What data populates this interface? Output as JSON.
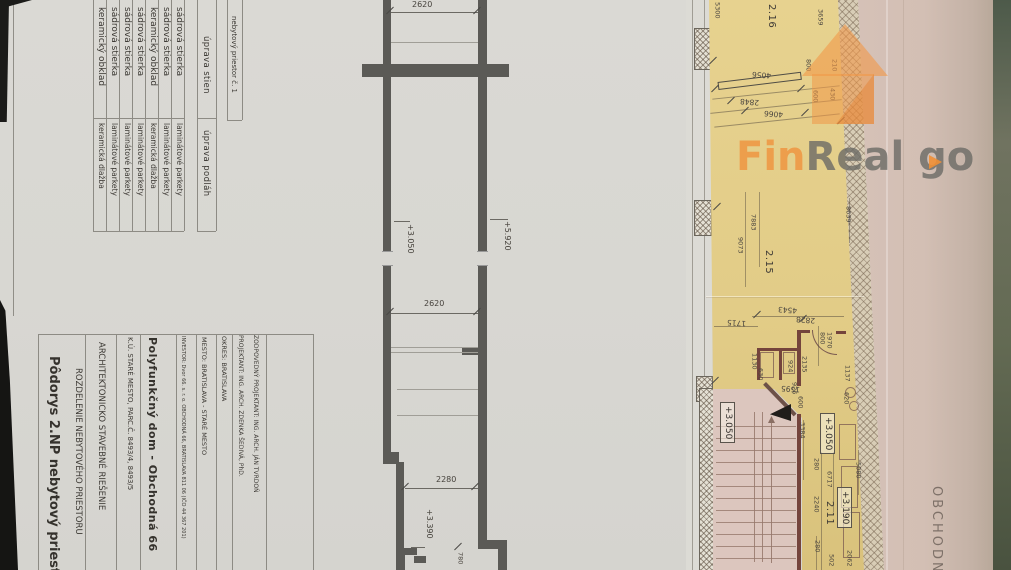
{
  "watermark": {
    "fin": "Fin",
    "real": "Real",
    "go": " go"
  },
  "materials_table": {
    "header": "nebytový priestor č. 1",
    "walls_header": "úprava stien",
    "floors_header": "úprava podláh",
    "rows": [
      {
        "walls": "keramický obklad",
        "floors": "keramická dlažba"
      },
      {
        "walls": "sádrová stierka",
        "floors": "laminátové parkety"
      },
      {
        "walls": "sádrová stierka",
        "floors": "laminátové parkety"
      },
      {
        "walls": "sádrová stierka",
        "floors": "laminátové parkety"
      },
      {
        "walls": "keramický obklad",
        "floors": "keramická dlažba"
      },
      {
        "walls": "sádrová stierka",
        "floors": "laminátové parkety"
      },
      {
        "walls": "sádrová stierka",
        "floors": "laminátové parkety"
      }
    ]
  },
  "title_block": {
    "drawing_title": "Pôdorys 2.NP nebytový priestor",
    "drawing_section": "ROZDELENIE NEBYTOVÉHO PRIESTORU",
    "discipline": "ARCHITEKTONICKO STAVEBNÉ RIEŠENIE",
    "cadastre": "K.Ú. STARÉ MESTO, PARC.Č. 8493/4, 8493/5",
    "project_title": "Polyfunkčný dom - Obchodná 66",
    "investor": "INVESTOR: Dvor 66. s. r. o. OBCHODNÁ 66, BRATISLAVA 811 06 (IČO 44 367 201)",
    "city": "MESTO: BRATISLAVA - STARÉ MESTO",
    "district": "OKRES: BRATISLAVA",
    "designer": "PROJEKTANT: ING. ARCH. ZDENKA ŠEDIVÁ, PhD.",
    "chief_designer": "ZODPOVEDNÝ PROJEKTANT: ING. ARCH. JÁN TVRDOŇ"
  },
  "plan_middle": {
    "labels": [
      {
        "t": "2620",
        "c": "dh",
        "x": 412,
        "y": 1
      },
      {
        "t": "+5.920",
        "c": "dv",
        "x": 503,
        "y": 221
      },
      {
        "t": "+3.050",
        "c": "dv",
        "x": 406,
        "y": 224
      },
      {
        "t": "2620",
        "c": "dh",
        "x": 424,
        "y": 300
      },
      {
        "t": "2280",
        "c": "dh",
        "x": 436,
        "y": 476
      },
      {
        "t": "+3.390",
        "c": "dv",
        "x": 425,
        "y": 509
      },
      {
        "t": "780",
        "c": "dvs",
        "x": 457,
        "y": 552
      }
    ]
  },
  "plan_right": {
    "labels": [
      {
        "t": "5300",
        "c": "dvs",
        "x": 714,
        "y": 2
      },
      {
        "t": "2.16",
        "c": "rm",
        "x": 766,
        "y": 4
      },
      {
        "t": "3659",
        "c": "dvs",
        "x": 817,
        "y": 9
      },
      {
        "t": "800",
        "c": "dvs",
        "x": 805,
        "y": 59
      },
      {
        "t": "210",
        "c": "dvs",
        "x": 831,
        "y": 59
      },
      {
        "t": "600",
        "c": "dvs",
        "x": 812,
        "y": 90
      },
      {
        "t": "430",
        "c": "dvs",
        "x": 829,
        "y": 88
      },
      {
        "t": "4056",
        "c": "du",
        "x": 752,
        "y": 71
      },
      {
        "t": "2848",
        "c": "du",
        "x": 740,
        "y": 98
      },
      {
        "t": "4066",
        "c": "du",
        "x": 764,
        "y": 110
      },
      {
        "t": "8639",
        "c": "dvs",
        "x": 845,
        "y": 206
      },
      {
        "t": "7883",
        "c": "dvs",
        "x": 750,
        "y": 214
      },
      {
        "t": "9073",
        "c": "dvs",
        "x": 737,
        "y": 237
      },
      {
        "t": "2.15",
        "c": "rm",
        "x": 763,
        "y": 250
      },
      {
        "t": "4543",
        "c": "du",
        "x": 778,
        "y": 306
      },
      {
        "t": "1715",
        "c": "du",
        "x": 727,
        "y": 319
      },
      {
        "t": "2828",
        "c": "du",
        "x": 796,
        "y": 316
      },
      {
        "t": "800",
        "c": "dvs",
        "x": 819,
        "y": 332
      },
      {
        "t": "1970",
        "c": "dvs",
        "x": 826,
        "y": 332
      },
      {
        "t": "1130",
        "c": "dvs",
        "x": 751,
        "y": 353
      },
      {
        "t": "630",
        "c": "dvs",
        "x": 757,
        "y": 368
      },
      {
        "t": "924",
        "c": "dvs",
        "x": 787,
        "y": 360
      },
      {
        "t": "2135",
        "c": "dvs",
        "x": 801,
        "y": 356
      },
      {
        "t": "1137",
        "c": "dvs",
        "x": 844,
        "y": 365
      },
      {
        "t": "1595",
        "c": "du",
        "x": 781,
        "y": 385
      },
      {
        "t": "926",
        "c": "dvs",
        "x": 791,
        "y": 382
      },
      {
        "t": "600",
        "c": "dvs",
        "x": 797,
        "y": 396
      },
      {
        "t": "620",
        "c": "dvs",
        "x": 843,
        "y": 392
      },
      {
        "t": "3384",
        "c": "dvs",
        "x": 799,
        "y": 422
      },
      {
        "t": "280",
        "c": "dvs",
        "x": 813,
        "y": 458
      },
      {
        "t": "6717",
        "c": "dvs",
        "x": 826,
        "y": 471
      },
      {
        "t": "5080",
        "c": "dvs",
        "x": 855,
        "y": 462
      },
      {
        "t": "2240",
        "c": "dvs",
        "x": 813,
        "y": 496
      },
      {
        "t": "2.11",
        "c": "rm",
        "x": 824,
        "y": 501
      },
      {
        "t": "280",
        "c": "dvs",
        "x": 814,
        "y": 540
      },
      {
        "t": "502",
        "c": "dvs",
        "x": 828,
        "y": 554
      },
      {
        "t": "2062",
        "c": "dvs",
        "x": 846,
        "y": 550
      },
      {
        "t": "+3.050",
        "c": "lv",
        "x": 720,
        "y": 402
      },
      {
        "t": "+3.050",
        "c": "lv",
        "x": 820,
        "y": 413
      },
      {
        "t": "+3.190",
        "c": "lv",
        "x": 837,
        "y": 487
      },
      {
        "t": "OBCHODNÁ",
        "c": "st",
        "x": 930,
        "y": 486
      }
    ]
  }
}
